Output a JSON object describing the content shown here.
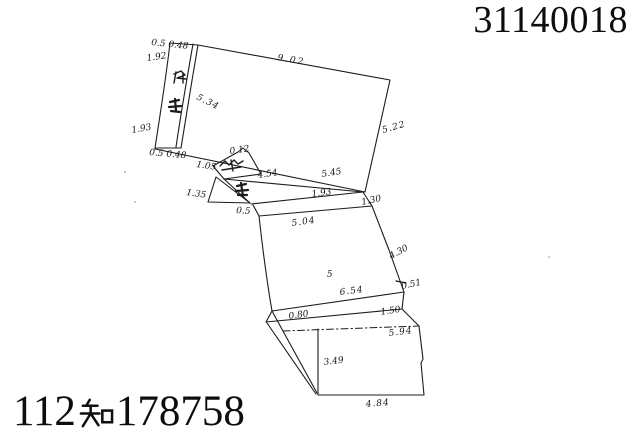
{
  "document": {
    "top_right_serial": "31140018",
    "bottom_left_reference": "112知178758",
    "bottom_left_parts": {
      "prefix": "112",
      "kanji": "知",
      "suffix": "178758"
    }
  },
  "sketch": {
    "parcel_number": "5",
    "line_color": "#1c1c1c",
    "labels": [
      {
        "name": "sliver-top-offsets",
        "text": "0.5 0.48"
      },
      {
        "name": "sliver-left-upper",
        "text": "1.92"
      },
      {
        "name": "sliver-inner-edge",
        "text": "5.34"
      },
      {
        "name": "sliver-left-lower",
        "text": "1.93"
      },
      {
        "name": "sliver-bottom-offsets",
        "text": "0.5 0.48"
      },
      {
        "name": "top-parcel-top-edge",
        "text": "9.02"
      },
      {
        "name": "top-parcel-right-edge",
        "text": "5.22"
      },
      {
        "name": "bottom-edge-left-seg",
        "text": "4.54"
      },
      {
        "name": "bottom-edge-right-seg",
        "text": "5.45"
      },
      {
        "name": "notch-width",
        "text": "0.12"
      },
      {
        "name": "small-quad-left",
        "text": "1.05"
      },
      {
        "name": "triangle-left",
        "text": "1.35"
      },
      {
        "name": "triangle-bottom",
        "text": "0.5"
      },
      {
        "name": "wedge-inner",
        "text": "1.93"
      },
      {
        "name": "connector-edge",
        "text": "1.30"
      },
      {
        "name": "parcel5-top-edge",
        "text": "5.04"
      },
      {
        "name": "parcel5-right-upper",
        "text": "4.30"
      },
      {
        "name": "parcel5-right-lower",
        "text": "0.51"
      },
      {
        "name": "parcel5-bottom-edge",
        "text": "6.54"
      },
      {
        "name": "band-left",
        "text": "0.80"
      },
      {
        "name": "band-right",
        "text": "1.50"
      },
      {
        "name": "bottom-rect-top",
        "text": "5.94"
      },
      {
        "name": "bottom-rect-inner",
        "text": "3.49"
      },
      {
        "name": "bottom-rect-bottom",
        "text": "4.84"
      }
    ]
  }
}
